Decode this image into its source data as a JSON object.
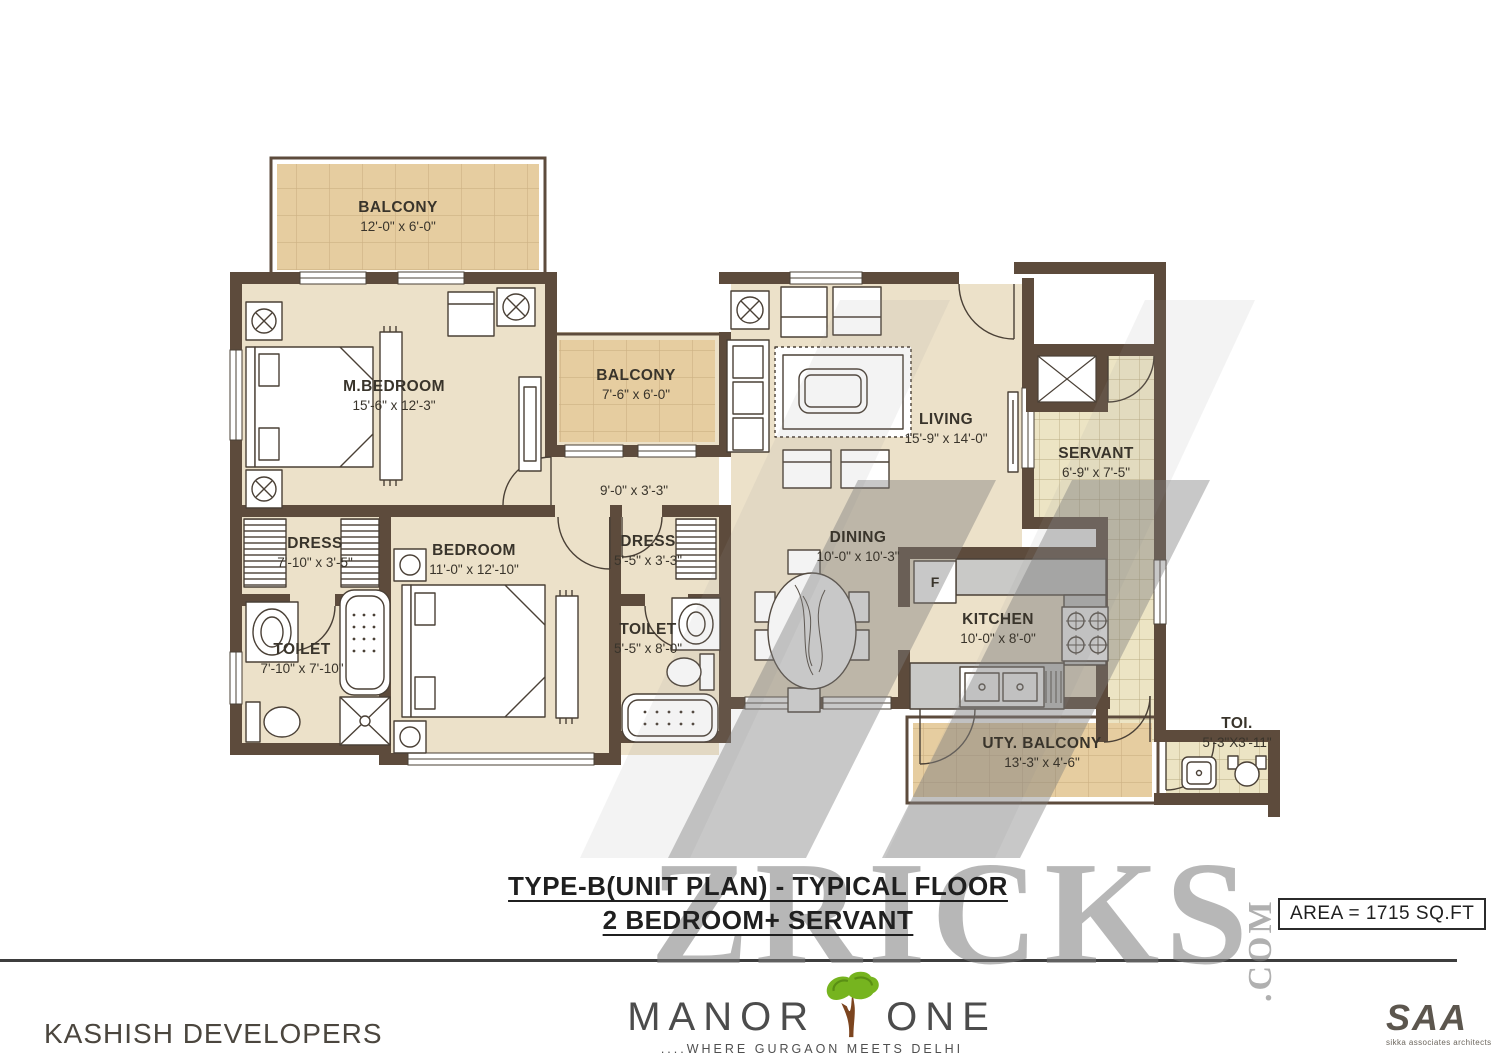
{
  "watermark": {
    "brand": "ZRICKS",
    "suffix": ".COM"
  },
  "plan": {
    "fridge_label": "F",
    "rooms": [
      {
        "id": "balcony-top",
        "name": "BALCONY",
        "dims": "12'-0\" x 6'-0\""
      },
      {
        "id": "m-bedroom",
        "name": "M.BEDROOM",
        "dims": "15'-6\" x 12'-3\""
      },
      {
        "id": "balcony-mid",
        "name": "BALCONY",
        "dims": "7'-6\" x 6'-0\""
      },
      {
        "id": "living",
        "name": "LIVING",
        "dims": "15'-9\" x 14'-0\""
      },
      {
        "id": "servant",
        "name": "SERVANT",
        "dims": "6'-9\" x 7'-5\""
      },
      {
        "id": "passage",
        "name": "",
        "dims": "9'-0\" x 3'-3\""
      },
      {
        "id": "dress-1",
        "name": "DRESS",
        "dims": "7'-10\" x 3'-5\""
      },
      {
        "id": "bedroom-2",
        "name": "BEDROOM",
        "dims": "11'-0\" x 12'-10\""
      },
      {
        "id": "dress-2",
        "name": "DRESS",
        "dims": "5'-5\" x 3'-3\""
      },
      {
        "id": "dining",
        "name": "DINING",
        "dims": "10'-0\" x 10'-3\""
      },
      {
        "id": "toilet-1",
        "name": "TOILET",
        "dims": "7'-10\" x 7'-10\""
      },
      {
        "id": "toilet-2",
        "name": "TOILET",
        "dims": "5'-5\" x 8'-0\""
      },
      {
        "id": "kitchen",
        "name": "KITCHEN",
        "dims": "10'-0\" x 8'-0\""
      },
      {
        "id": "uty-balcony",
        "name": "UTY. BALCONY",
        "dims": "13'-3\" x 4'-6\""
      },
      {
        "id": "toi",
        "name": "TOI.",
        "dims": "5'-3\"X3'-11\""
      }
    ]
  },
  "title": {
    "line1": "TYPE-B(UNIT PLAN) - TYPICAL FLOOR",
    "line2": "2 BEDROOM+ SERVANT"
  },
  "area_box": {
    "label": "AREA = 1715 SQ.FT"
  },
  "footer": {
    "developer": "KASHISH DEVELOPERS",
    "brand": {
      "word1": "MANOR",
      "word2": "ONE",
      "tagline": "....WHERE GURGAON MEETS DELHI"
    },
    "architect": {
      "logo": "SAA",
      "caption": "sikka associates architects"
    }
  },
  "colors": {
    "wall": "#5d4b3c",
    "floor": "#ece1c9",
    "balcony_floor": "#e6cda0",
    "balcony_grid": "#cdb184",
    "tile_floor": "#ece4c4",
    "tile_grid": "#b9ac82",
    "counter": "#c9c9c7",
    "line": "#4a4036",
    "watermark": "#7d7d7d",
    "accent_green": "#76b41f",
    "trunk_brown": "#7c451f",
    "text": "#39342b"
  }
}
